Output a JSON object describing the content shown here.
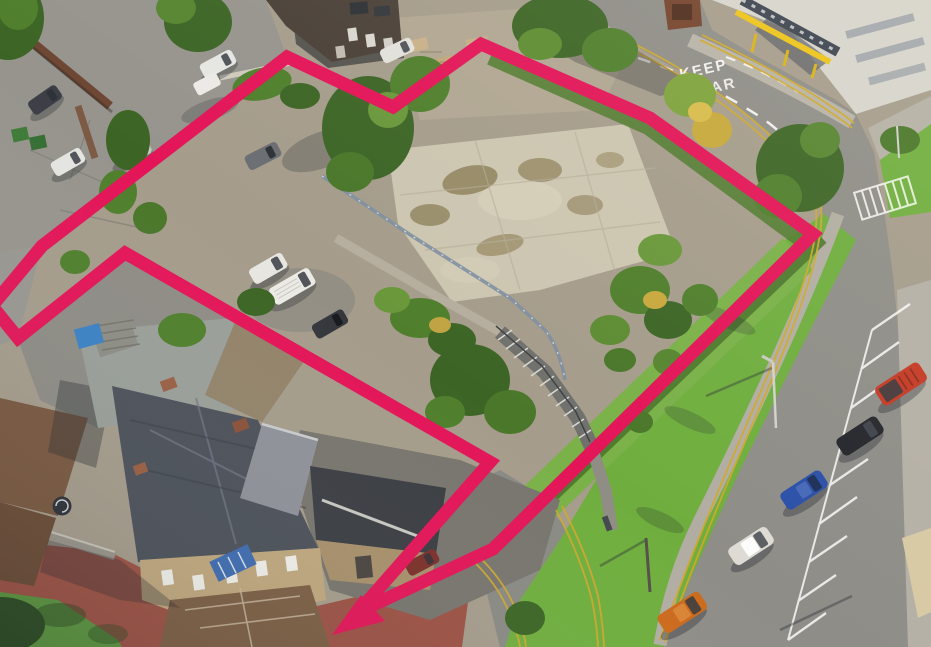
{
  "photo": {
    "kind": "aerial-site-photograph",
    "road_marking": {
      "line1": "KEEP",
      "line2": "CLEAR"
    }
  },
  "site_boundary": {
    "color": "#e31558",
    "stroke_width": 13
  },
  "palette": {
    "gravel": "#a59c8b",
    "tarmac": "#96948d",
    "road": "#8e8d87",
    "sidewalk": "#b2ada2",
    "slab": "#ccc5b0",
    "grass_verge": "#6fae3e",
    "lawn_strip": "#7ab148",
    "tree_dark": "#3c6525",
    "tree_mid": "#4f7f2c",
    "tree_light": "#69973a",
    "roof_slate": "#4c515a",
    "roof_brown": "#7a5940",
    "paving_pink": "#9c5244",
    "yellow_line": "#cfa82e",
    "canopy_yellow": "#ecc318",
    "building_facade": "#d6d4cc"
  },
  "cars": {
    "car_park_row": [
      {
        "id": "red-van",
        "color": "#c43a24"
      },
      {
        "id": "black-car",
        "color": "#24262b"
      },
      {
        "id": "blue-car",
        "color": "#2b50a8"
      },
      {
        "id": "white-car",
        "color": "#dedad4"
      },
      {
        "id": "orange-car",
        "color": "#cc6a1c"
      }
    ],
    "left_lot": [
      {
        "id": "dark-grey-car",
        "color": "#3c4046"
      },
      {
        "id": "white-suv",
        "color": "#e6e6e2"
      },
      {
        "id": "white-van-top",
        "color": "#eceae6"
      },
      {
        "id": "white-hatch",
        "color": "#e4e4e0"
      },
      {
        "id": "silver-car",
        "color": "#c6c8c8"
      }
    ],
    "site_lot": [
      {
        "id": "grey-hatch",
        "color": "#6a6e72"
      },
      {
        "id": "white-car",
        "color": "#e8e6e0"
      },
      {
        "id": "white-van",
        "color": "#eceae4"
      },
      {
        "id": "dark-car",
        "color": "#34373c"
      },
      {
        "id": "white-car-north",
        "color": "#e2e0da"
      },
      {
        "id": "maroon-car",
        "color": "#7c2f2a"
      }
    ]
  }
}
